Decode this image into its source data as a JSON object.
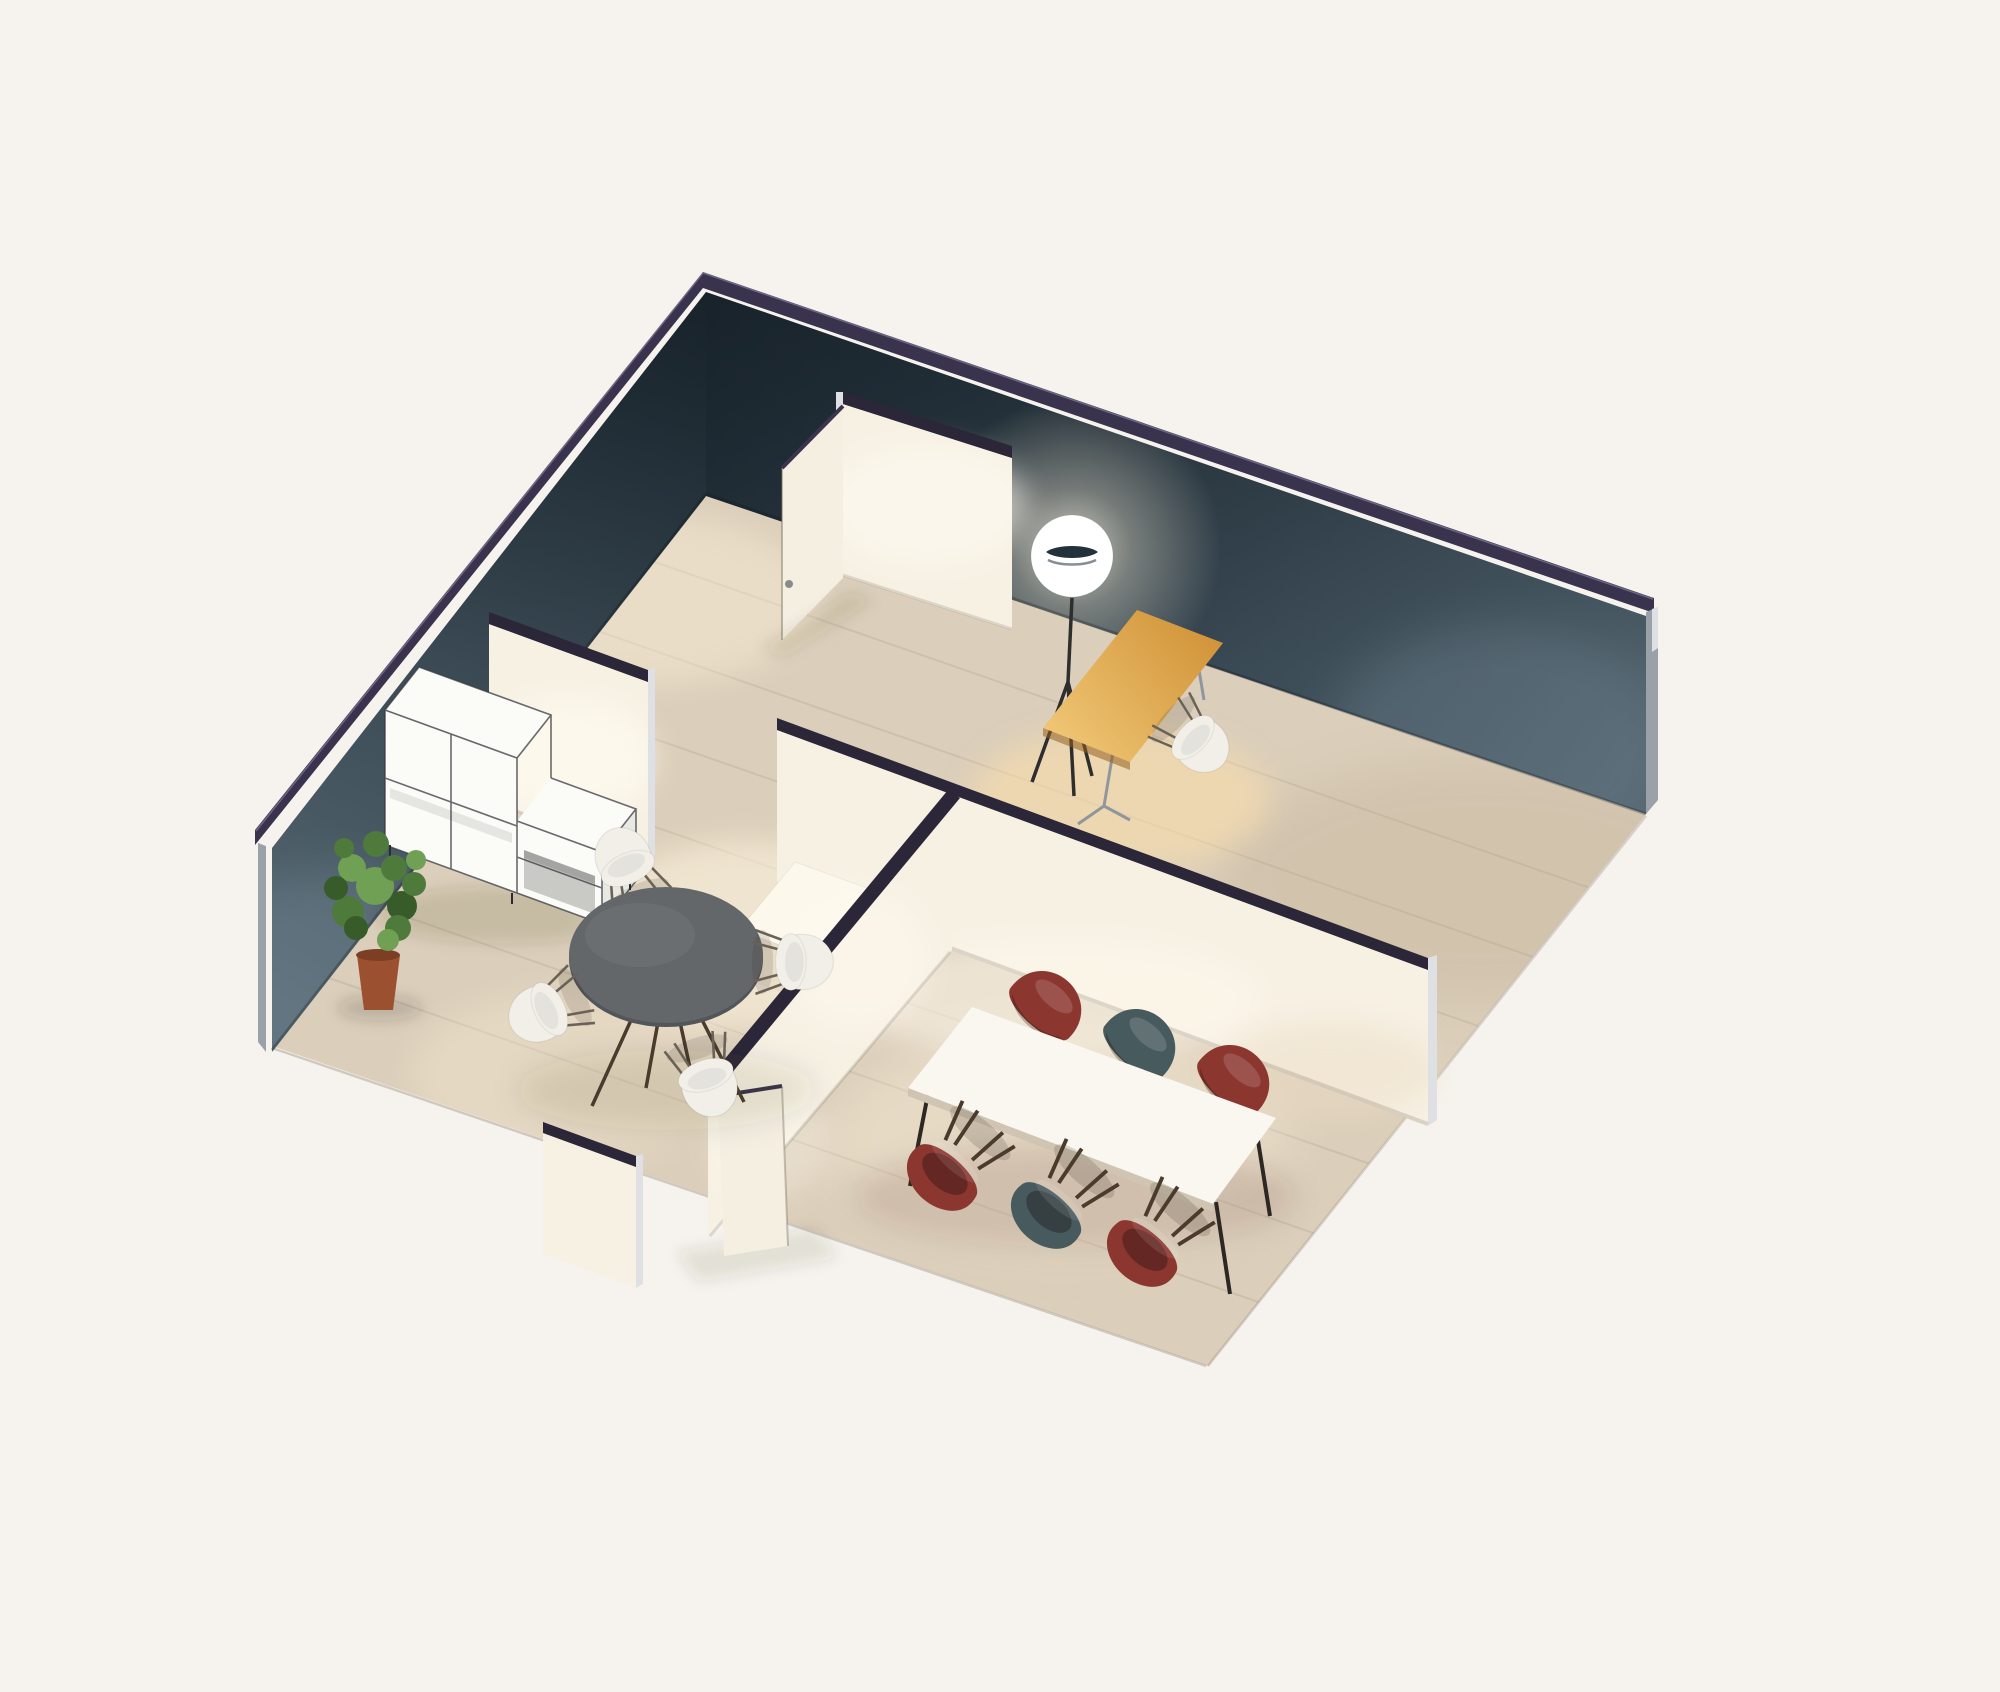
{
  "meta": {
    "kind": "isometric-3d-floorplan-render",
    "rooms": [
      "office-room",
      "meeting-room",
      "conference-room",
      "hallway"
    ]
  },
  "colors": {
    "background": "#f6f3ee",
    "band_outer": "#39334d",
    "band_inner": "#2c2738",
    "band_highlight": "#7a7492",
    "wall_dark_top": "#223039",
    "wall_dark": "#3a4a55",
    "wall_dark_light": "#546671",
    "wall_cap": "#9aa1a9",
    "wall_cap_bright": "#dfe0e3",
    "int_wall": "#f7f1e4",
    "int_wall_bright": "#fdf8ec",
    "int_wall_shade": "#e9ddc9",
    "door_leaf": "#f5efe2",
    "door_handle": "#8a8a8a",
    "floor": "#dbceba",
    "floor_light": "#efe4d2",
    "floor_warm_pool": "#ffedc4",
    "plank_seam": "#8a7a62",
    "desk_wood_light": "#f0c776",
    "desk_wood_dark": "#d09136",
    "desk_leg": "#8f969c",
    "round_table": "#64676a",
    "round_table_dark": "#52555a",
    "conference_table": "#faf7f0",
    "conference_table_edge": "#cfc5b2",
    "chair_white": "#f1efe8",
    "chair_red": "#8c3630",
    "chair_teal": "#475a5e",
    "chair_leg_wire": "#6b6257",
    "chair_leg_wood": "#4a3b2d",
    "lamp_shade": "#ffffff",
    "lamp_eye": "#22323c",
    "lamp_leg": "#2e2e2e",
    "shelf_white": "#fbfbf8",
    "shelf_side": "#e9e9e4",
    "shelf_frame": "#3a3a40",
    "shelf_open": "#c9cac6",
    "plant_green_dark": "#375c2a",
    "plant_green_mid": "#4e7a3c",
    "plant_green_light": "#6fa054",
    "plant_pot": "#9b5130",
    "plant_pot_rim": "#7d3f24"
  },
  "scene": {
    "objects": [
      {
        "name": "back-left-wall",
        "color_ref": "wall_dark"
      },
      {
        "name": "back-right-wall",
        "color_ref": "wall_dark"
      },
      {
        "name": "partition-wall-top",
        "color_ref": "int_wall"
      },
      {
        "name": "partition-wall-shelf",
        "color_ref": "int_wall"
      },
      {
        "name": "partition-wall-conference",
        "color_ref": "int_wall"
      },
      {
        "name": "partition-wall-corridor",
        "color_ref": "int_wall"
      },
      {
        "name": "front-wall-stub",
        "color_ref": "int_wall"
      },
      {
        "name": "open-door-top",
        "color_ref": "door_leaf"
      },
      {
        "name": "open-door-corridor",
        "color_ref": "door_leaf"
      },
      {
        "name": "wood-floor",
        "color_ref": "floor"
      },
      {
        "name": "floor-lamp",
        "color_ref": "lamp_shade"
      },
      {
        "name": "wooden-desk",
        "color_ref": "desk_wood_light"
      },
      {
        "name": "desk-chair-white",
        "color_ref": "chair_white"
      },
      {
        "name": "round-meeting-table",
        "color_ref": "round_table"
      },
      {
        "name": "meeting-chairs-white",
        "count": 4,
        "color_ref": "chair_white"
      },
      {
        "name": "modular-shelf-unit",
        "color_ref": "shelf_white"
      },
      {
        "name": "potted-plant",
        "color_ref": "plant_green_mid"
      },
      {
        "name": "kitchen-counter",
        "color_ref": "int_wall_bright"
      },
      {
        "name": "conference-table",
        "color_ref": "conference_table"
      },
      {
        "name": "conference-chairs-red",
        "count": 4,
        "color_ref": "chair_red"
      },
      {
        "name": "conference-chairs-teal",
        "count": 2,
        "color_ref": "chair_teal"
      }
    ]
  }
}
